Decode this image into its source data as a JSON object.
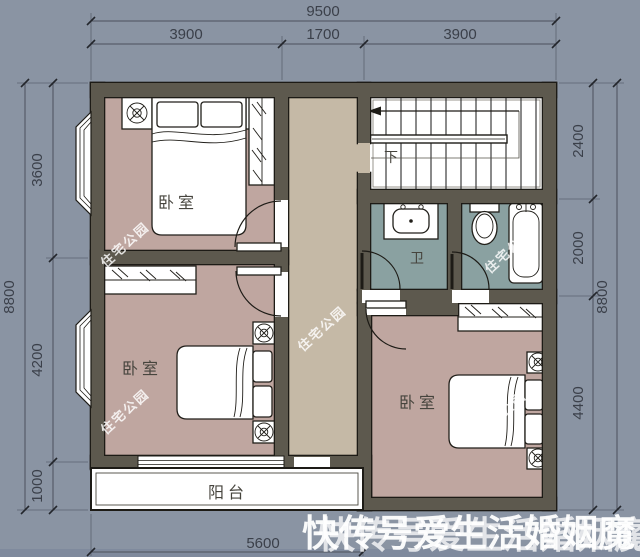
{
  "dimensions": {
    "top": {
      "total": "9500",
      "segments": [
        "3900",
        "1700",
        "3900"
      ]
    },
    "left": {
      "total": "8800",
      "segments": [
        "3600",
        "4200",
        "1000"
      ]
    },
    "right": {
      "total": "8800",
      "segments": [
        "2400",
        "2000",
        "4400"
      ]
    },
    "bottom": {
      "width": "5600"
    }
  },
  "rooms": {
    "bedroom_top_left": "卧室",
    "bedroom_bottom_left": "卧室",
    "bedroom_bottom_right": "卧室",
    "bathroom": "卫",
    "balcony": "阳台",
    "stairs_direction": "下"
  },
  "watermarks": {
    "site": "住宅公园",
    "bottom": "快传号爱生活婚姻魔"
  },
  "colors": {
    "background": "#8A94A3",
    "wall": "#5D594E",
    "wall_outline": "#1D1B16",
    "bedroom_floor": "#BFA6A0",
    "hall_floor": "#C5B9A6",
    "bath_floor": "#8AA1A1",
    "stairs_floor": "#FFFFFF",
    "dimension_text": "#3B404A",
    "watermark": "#FFFFFF"
  }
}
